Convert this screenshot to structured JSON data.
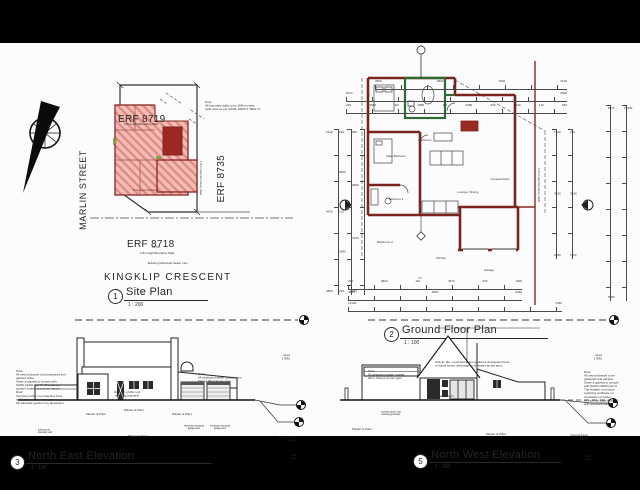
{
  "colors": {
    "wall_red": "#7b231f",
    "solid_red": "#9b2a22",
    "hatch_fill": "#f4bcb6",
    "hatch_line": "#dd8a82",
    "green_wall": "#2e6b33",
    "ink": "#2a2a2a",
    "sheet": "#fcfcfc",
    "frame": "#000000"
  },
  "icons": {
    "north_arrow": "north-arrow-compass",
    "datum_target": "survey-datum-marker",
    "section_marker": "section-cut-marker"
  },
  "site": {
    "title": {
      "num": "1",
      "name": "Site Plan",
      "scale": "1 : 200"
    },
    "erf_top": "ERF 8719",
    "erf_right": "ERF 8735",
    "erf_bottom": "ERF 8718",
    "street": "MARLIN STREET",
    "crescent": "KINGKLIP CRESCENT",
    "dwelling": "Proposed Dwelling",
    "note": [
      "Note:",
      "All boundary walls to be 180mm wide",
      "solid units as per SANS 10400 X Table 17"
    ],
    "boundary_wall": "1.8m High Boundary Wall",
    "sewer": "Existing Municipal Sewer Line",
    "dim_bottom": "24,51",
    "dim_left": "31,42"
  },
  "gfp": {
    "title": {
      "num": "2",
      "name": "Ground Floor Plan",
      "scale": "1 : 100"
    },
    "rooms": {
      "main_bedroom": "Main Bedroom",
      "bathroom": "Bathroom",
      "bedroom2": "Bedroom 2",
      "bath2": "Bathroom 2",
      "lounge": "Lounge / Dining",
      "kitchen": "Kitchen",
      "patio": "Covered Patio",
      "garage": "Garage"
    },
    "braai": "Braai",
    "tag": "103",
    "boundary_wall": "1.8m High Boundary Wall",
    "dims": {
      "top1": [
        "3660",
        "4800",
        "1540",
        "2130"
      ],
      "top2": [
        "8110",
        "6520"
      ],
      "top3": [
        "230",
        "3660",
        "110",
        "1880",
        "110",
        "2980",
        "230",
        "1540",
        "110",
        "940"
      ],
      "bottom1": [
        "230",
        "4800",
        "110",
        "4570",
        "230",
        "1000"
      ],
      "bottom2": [
        "4880",
        "4800",
        "2230"
      ],
      "bottom3": [
        "13140",
        "1460"
      ],
      "left1": [
        "1540",
        "6630",
        "4800"
      ],
      "left2": [
        "230",
        "3660",
        "110",
        "2980",
        "230"
      ],
      "left3": [
        "960",
        "2880",
        "1540",
        "940"
      ],
      "right1": [
        "1540",
        "4230",
        "2980"
      ],
      "right2": [
        "230",
        "3660",
        "6110"
      ],
      "right3": [
        "8110",
        "6980"
      ],
      "right4": [
        "15090"
      ]
    }
  },
  "ne": {
    "title": {
      "num": "3",
      "name": "North East Elevation",
      "scale": "1 : 100"
    },
    "datum": {
      "apex": "Apex",
      "apex_v": "17640",
      "gf": "Ground Floor",
      "gf_v": "13040",
      "ngl": "NGL",
      "ngl_v": "9640"
    },
    "roof_label": [
      "Victorian profile roof",
      "sheeting (painted)"
    ],
    "plaster": "Plaster & Paint",
    "garage_door": [
      "Aluminium sectional",
      "garage door"
    ],
    "low_wall": [
      "Existing low",
      "boundary wall"
    ],
    "notes_left": [
      "Note:",
      "All new brickwork to be plastered and",
      "painted white.",
      "Glass & glazing to comply with",
      "SANS 10400 part N. All windows",
      "powder coated aluminium frames.",
      "Roof:",
      "Victorian profile roof sheeting fixed",
      "to SA pine purlins as per spec.",
      "All rainwater goods to be aluminium."
    ],
    "notes_mid": [
      "Note:",
      "All windows powder coated alum.",
      "frames fitted as per spec."
    ]
  },
  "nw": {
    "title": {
      "num": "5",
      "name": "North West Elevation",
      "scale": "1 : 100"
    },
    "datum": {
      "apex": "Apex",
      "apex_v": "17640",
      "gf": "Ground Floor",
      "gf_v": "13040",
      "ngl": "NGL",
      "ngl_v": "9640"
    },
    "band_label": [
      "Victorian profile roof",
      "sheeting (painted)"
    ],
    "plaster": "Plaster & Paint",
    "callout": [
      "100mm dia. round aluminium gutters & downpipes fixed",
      "to fascia board, discharge to rainwater as per spec."
    ],
    "notes_left": [
      "Note:",
      "All windows powder coated",
      "alum. frames as per spec."
    ],
    "notes_right": [
      "Note:",
      "All new brickwork to be",
      "plastered and painted.",
      "Glass & glazing to comply",
      "with SANS 10400 part N.",
      "The installer is to issue",
      "a glazing certificate on",
      "completion of works.",
      "All external walls finished",
      "with a smooth plaster."
    ]
  }
}
